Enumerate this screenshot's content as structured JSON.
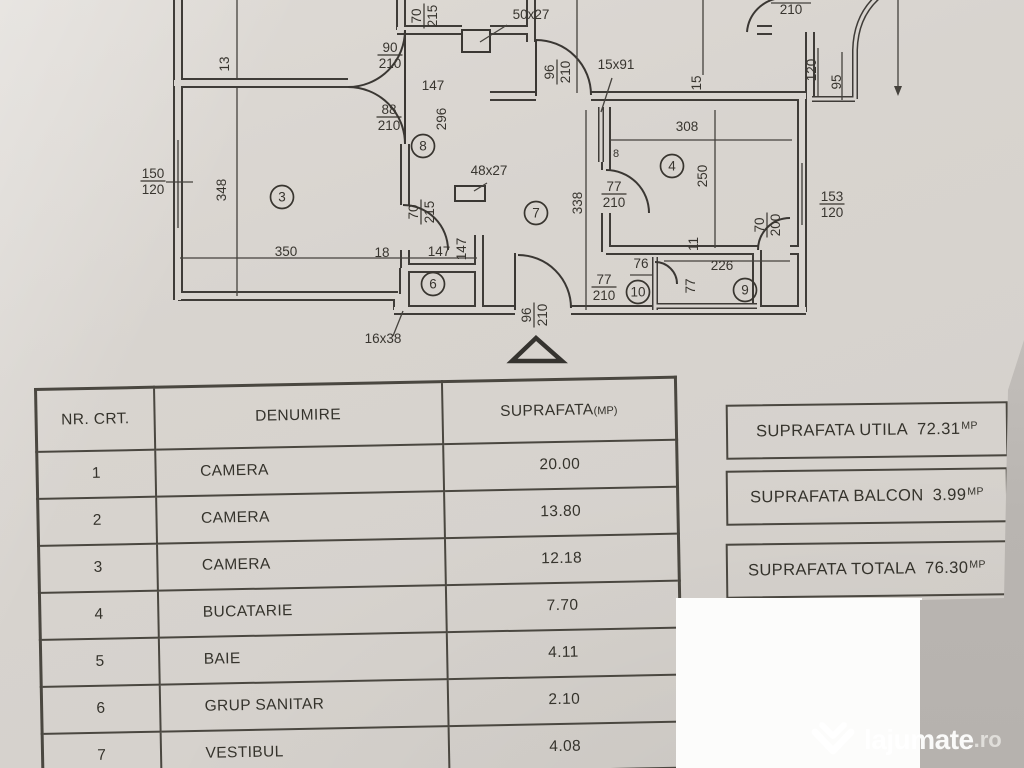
{
  "photo": {
    "paper_color": "#d8d4cf",
    "ink_color": "#3a3733",
    "patch_color": "#fcfcfb",
    "background_gray": "#b9b5b1",
    "watermark_color": "#ffffff"
  },
  "plan": {
    "dim_labels": [
      {
        "text": "50x27",
        "x": 531,
        "y": 19,
        "rot": 0
      },
      {
        "text": "147",
        "x": 433,
        "y": 90,
        "rot": 0
      },
      {
        "text": "15x91",
        "x": 616,
        "y": 69,
        "rot": 0
      },
      {
        "text": "308",
        "x": 687,
        "y": 131,
        "rot": 0
      },
      {
        "text": "210",
        "x": 791,
        "y": 14,
        "rot": 0
      },
      {
        "text": "350",
        "x": 286,
        "y": 256,
        "rot": 0
      },
      {
        "text": "18",
        "x": 382,
        "y": 257,
        "rot": 0
      },
      {
        "text": "147",
        "x": 439,
        "y": 256,
        "rot": 0
      },
      {
        "text": "48x27",
        "x": 489,
        "y": 175,
        "rot": 0
      },
      {
        "text": "226",
        "x": 722,
        "y": 270,
        "rot": 0
      },
      {
        "text": "76",
        "x": 641,
        "y": 268,
        "rot": 0
      },
      {
        "text": "16x38",
        "x": 383,
        "y": 343,
        "rot": 0
      },
      {
        "text": "8",
        "x": 616,
        "y": 157,
        "rot": 0,
        "small": true
      },
      {
        "text": "13",
        "x": 229,
        "y": 64,
        "rot": -90
      },
      {
        "text": "296",
        "x": 446,
        "y": 119,
        "rot": -90
      },
      {
        "text": "348",
        "x": 226,
        "y": 190,
        "rot": -90
      },
      {
        "text": "338",
        "x": 582,
        "y": 203,
        "rot": -90
      },
      {
        "text": "250",
        "x": 707,
        "y": 176,
        "rot": -90
      },
      {
        "text": "15",
        "x": 701,
        "y": 83,
        "rot": -90
      },
      {
        "text": "120",
        "x": 816,
        "y": 70,
        "rot": -90
      },
      {
        "text": "95",
        "x": 841,
        "y": 82,
        "rot": -90
      },
      {
        "text": "11",
        "x": 698,
        "y": 244,
        "rot": -90
      },
      {
        "text": "77",
        "x": 695,
        "y": 286,
        "rot": -90
      },
      {
        "text": "147",
        "x": 466,
        "y": 249,
        "rot": -90
      }
    ],
    "fraction_labels": [
      {
        "top": "90",
        "bottom": "210",
        "x": 390,
        "y": 55,
        "rot": 0
      },
      {
        "top": "88",
        "bottom": "210",
        "x": 389,
        "y": 117,
        "rot": 0
      },
      {
        "top": "153",
        "bottom": "120",
        "x": 832,
        "y": 204,
        "rot": 0
      },
      {
        "top": "150",
        "bottom": "120",
        "x": 153,
        "y": 181,
        "rot": 0
      },
      {
        "top": "77",
        "bottom": "210",
        "x": 614,
        "y": 194,
        "rot": 0
      },
      {
        "top": "77",
        "bottom": "210",
        "x": 604,
        "y": 287,
        "rot": 0
      },
      {
        "top": "70",
        "bottom": "215",
        "x": 424,
        "y": 16,
        "rot": -90
      },
      {
        "top": "96",
        "bottom": "210",
        "x": 557,
        "y": 72,
        "rot": -90
      },
      {
        "top": "70",
        "bottom": "215",
        "x": 421,
        "y": 212,
        "rot": -90
      },
      {
        "top": "70",
        "bottom": "200",
        "x": 767,
        "y": 225,
        "rot": -90
      },
      {
        "top": "96",
        "bottom": "210",
        "x": 534,
        "y": 315,
        "rot": -90
      }
    ],
    "room_numbers": [
      {
        "num": "3",
        "x": 282,
        "y": 197
      },
      {
        "num": "4",
        "x": 672,
        "y": 166
      },
      {
        "num": "6",
        "x": 433,
        "y": 284
      },
      {
        "num": "7",
        "x": 536,
        "y": 213
      },
      {
        "num": "8",
        "x": 423,
        "y": 146
      },
      {
        "num": "9",
        "x": 745,
        "y": 290
      },
      {
        "num": "10",
        "x": 638,
        "y": 292
      }
    ]
  },
  "table": {
    "headers": {
      "col1": "NR. CRT.",
      "col2": "DENUMIRE",
      "col3": "SUPRAFATA",
      "col3_unit": "(MP)"
    },
    "rows": [
      {
        "nr": "1",
        "name": "CAMERA",
        "area": "20.00"
      },
      {
        "nr": "2",
        "name": "CAMERA",
        "area": "13.80"
      },
      {
        "nr": "3",
        "name": "CAMERA",
        "area": "12.18"
      },
      {
        "nr": "4",
        "name": "BUCATARIE",
        "area": "7.70"
      },
      {
        "nr": "5",
        "name": "BAIE",
        "area": "4.11"
      },
      {
        "nr": "6",
        "name": "GRUP SANITAR",
        "area": "2.10"
      },
      {
        "nr": "7",
        "name": "VESTIBUL",
        "area": "4.08"
      }
    ]
  },
  "summary_boxes": [
    {
      "label": "SUPRAFATA UTILA",
      "value": "72.31",
      "unit": "MP"
    },
    {
      "label": "SUPRAFATA BALCON",
      "value": "3.99",
      "unit": "MP"
    },
    {
      "label": "SUPRAFATA TOTALA",
      "value": "76.30",
      "unit": "MP"
    }
  ],
  "watermark": {
    "brand": "lajumate",
    "tld": ".ro"
  }
}
